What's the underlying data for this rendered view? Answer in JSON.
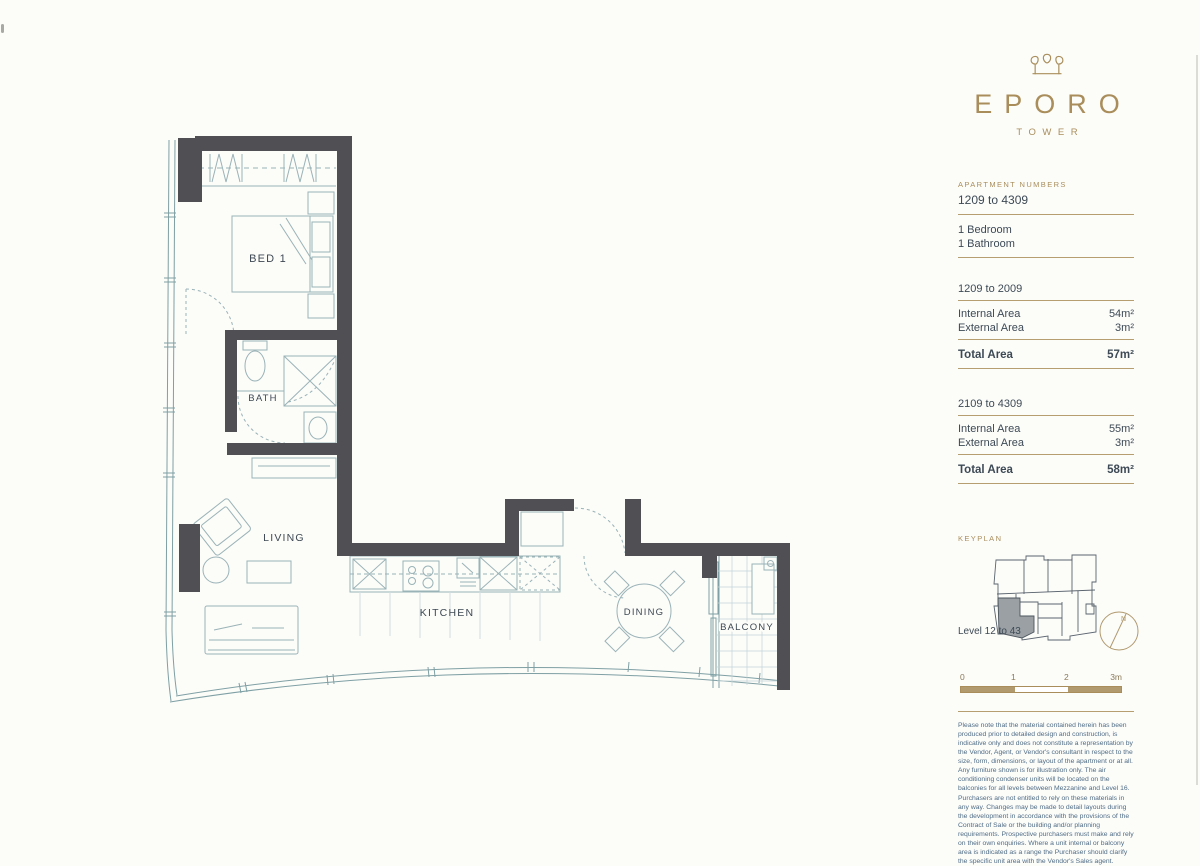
{
  "branding": {
    "logo": "EPORO",
    "logo_sub": "TOWER"
  },
  "details": {
    "apartment_numbers_label": "APARTMENT NUMBERS",
    "apartment_numbers": "1209 to 4309",
    "bedrooms": "1 Bedroom",
    "bathrooms": "1 Bathroom",
    "tables": [
      {
        "range": "1209 to 2009",
        "rows": [
          {
            "label": "Internal Area",
            "value": "54m²"
          },
          {
            "label": "External Area",
            "value": "3m²"
          }
        ],
        "total_label": "Total Area",
        "total_value": "57m²"
      },
      {
        "range": "2109 to 4309",
        "rows": [
          {
            "label": "Internal Area",
            "value": "55m²"
          },
          {
            "label": "External Area",
            "value": "3m²"
          }
        ],
        "total_label": "Total Area",
        "total_value": "58m²"
      }
    ]
  },
  "keyplan": {
    "label": "KEYPLAN",
    "level": "Level 12 to 43",
    "north": "N"
  },
  "scalebar": {
    "ticks": [
      "0",
      "1",
      "2",
      "3m"
    ]
  },
  "floorplan": {
    "rooms": {
      "bed": "BED 1",
      "bath": "BATH",
      "living": "LIVING",
      "kitchen": "KITCHEN",
      "dining": "DINING",
      "balcony": "BALCONY"
    }
  },
  "disclaimer": "Please note that the material contained herein has been produced prior to detailed design and construction, is indicative only and does not constitute a representation by the Vendor, Agent, or Vendor's consultant in respect to the size, form, dimensions, or layout of the apartment or at all. Any furniture shown is for illustration only. The air conditioning condenser units will be located on the balconies for all levels between Mezzanine and Level 16. Purchasers are not entitled to rely on these materials in any way. Changes may be made to detail layouts during the development in accordance with the provisions of the Contract of Sale or the building and/or planning requirements. Prospective purchasers must make and rely on their own enquiries. Where a unit internal or balcony area is indicated as a range the Purchaser should clarify the specific unit area with the Vendor's Sales agent.",
  "colors": {
    "gold": "#a98e5b",
    "wall": "#4f4f54",
    "plan_line": "#7fa0a4",
    "text": "#3d4a55",
    "disclaimer_text": "#4f6d86"
  }
}
